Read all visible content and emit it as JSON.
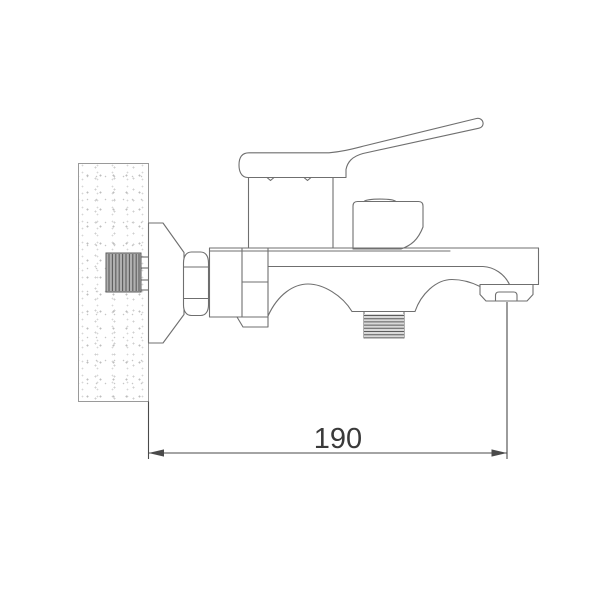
{
  "dimension": {
    "value_label": "190"
  },
  "colors": {
    "line": "#6f6f6f",
    "dim_line": "#4a4a4a",
    "text": "#3a3a3a",
    "metal_fill": "#b0b0b0",
    "metal_line": "#5c5c5c",
    "thread_fill": "#d9d9d9",
    "background": "#ffffff"
  }
}
